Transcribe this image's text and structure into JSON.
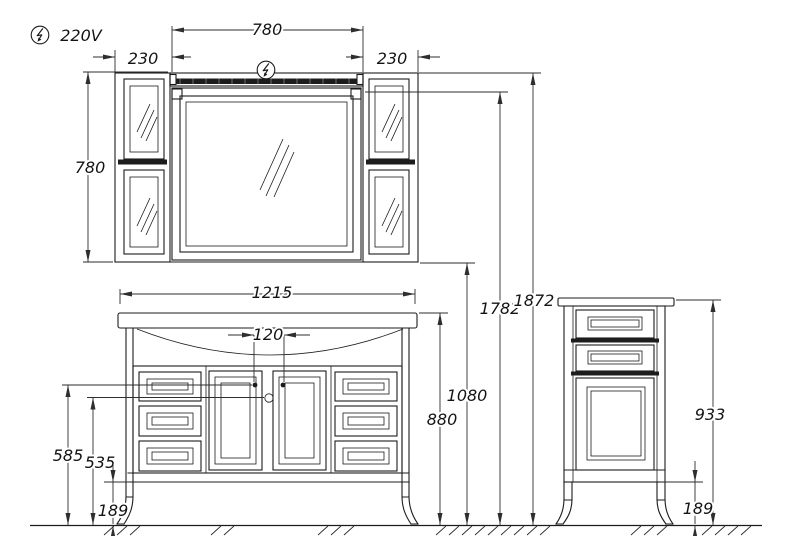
{
  "power": {
    "voltage": "220V"
  },
  "dims": {
    "light_width": "780",
    "left_cabinet_width": "230",
    "right_cabinet_width": "230",
    "mirror_unit_height": "780",
    "countertop_width": "1215",
    "knob_spacing": "120",
    "total_height": "1872",
    "mirror_top_height": "1782",
    "unit_bottom_height": "1080",
    "countertop_height": "880",
    "knob_height": "585",
    "lock_height": "535",
    "vanity_leg_height": "189",
    "side_cabinet_height": "933",
    "side_cabinet_leg_height": "189"
  },
  "colors": {
    "line": "#1c1c1c",
    "dim_line": "#2e2e2e",
    "background": "#ffffff",
    "light_strip": "#1d1d1d"
  }
}
